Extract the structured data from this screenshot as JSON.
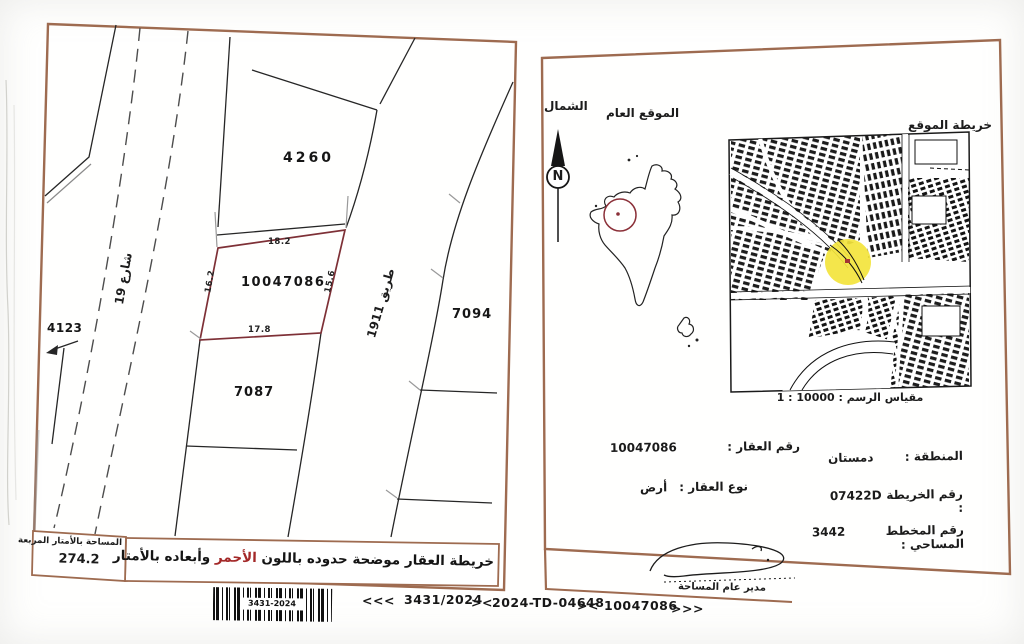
{
  "left_panel": {
    "parcel_4260": "4260",
    "parcel_main": "10047086",
    "parcel_7094": "7094",
    "parcel_7087": "7087",
    "parcel_4123": "4123",
    "street_19": "شارع 19",
    "road_1911": "طريق 1911",
    "dim_top": "18.2",
    "dim_left": "16.2",
    "dim_right": "15.6",
    "dim_bottom": "17.8",
    "area_label": "المساحة بالأمتار المربعة",
    "area_value": "274.2",
    "note_prefix": "خريطة العقار موضحة حدوده باللون",
    "note_red": "الأحمر",
    "note_suffix": "وأبعاده بالأمتار"
  },
  "right_panel": {
    "north_label": "الشمال",
    "compass_letter": "N",
    "general_location_label": "الموقع العام",
    "site_map_label": "خريطة الموقع",
    "scale_text": "مقياس الرسم : 10000 : 1",
    "details": {
      "property_number_label": "رقم العقار :",
      "property_number_value": "10047086",
      "property_type_label": "نوع العقار :",
      "property_type_value": "أرض",
      "region_label": "المنطقة :",
      "region_value": "دمستان",
      "map_number_label": "رقم الخريطة :",
      "map_number_value": "07422D",
      "plan_number_label": "رقم المخطط المساحي :",
      "plan_number_value": "3442"
    },
    "signature_label": "مدير عام المساحة"
  },
  "footer": {
    "barcode_text": "3431-2024",
    "items": [
      "<<<",
      "3431/2024",
      "><",
      "2024-TD-04648",
      "><",
      "10047086",
      ">>>"
    ]
  },
  "colors": {
    "border_sepia": "#9e6b50",
    "parcel_outline_red": "#7e3036",
    "highlight_yellow": "#f3e43c",
    "note_red": "#a32828"
  }
}
